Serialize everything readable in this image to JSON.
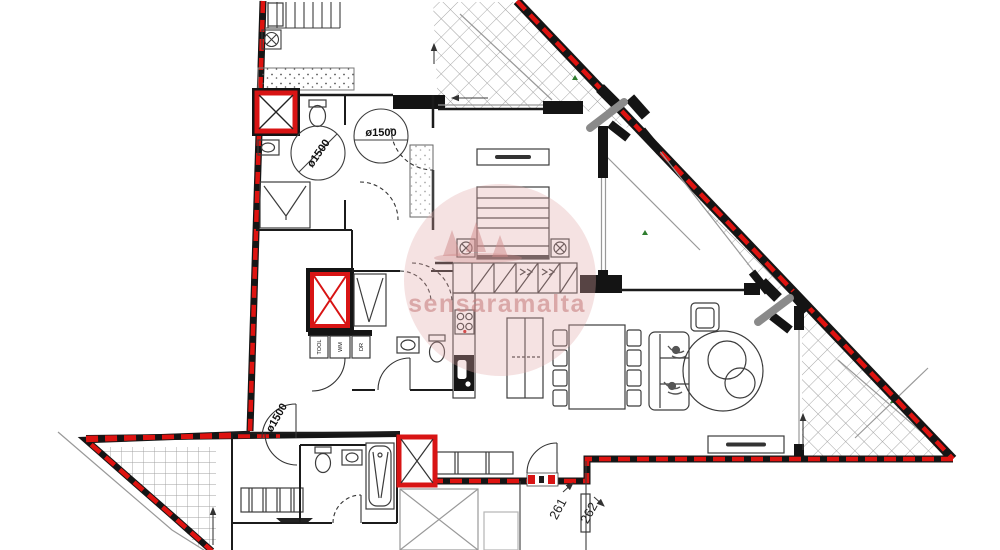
{
  "plan": {
    "watermark": {
      "text": "sensaramalta"
    },
    "labels": {
      "turning_circle_bathroom": "ø1500",
      "turning_circle_hall": "ø1500",
      "turning_circle_lower_hall": "ø1500",
      "appliance_left": "TOOL",
      "appliance_middle": "WM",
      "appliance_right": "DR",
      "door_number_left": "261",
      "door_number_right": "262"
    },
    "colors": {
      "boundary_red": "#de1310",
      "wall_black": "#1b1b1b",
      "hatch_gray": "#9a9a9a",
      "shaft_red": "#d81414",
      "watermark_pink": "#cc8585"
    }
  }
}
